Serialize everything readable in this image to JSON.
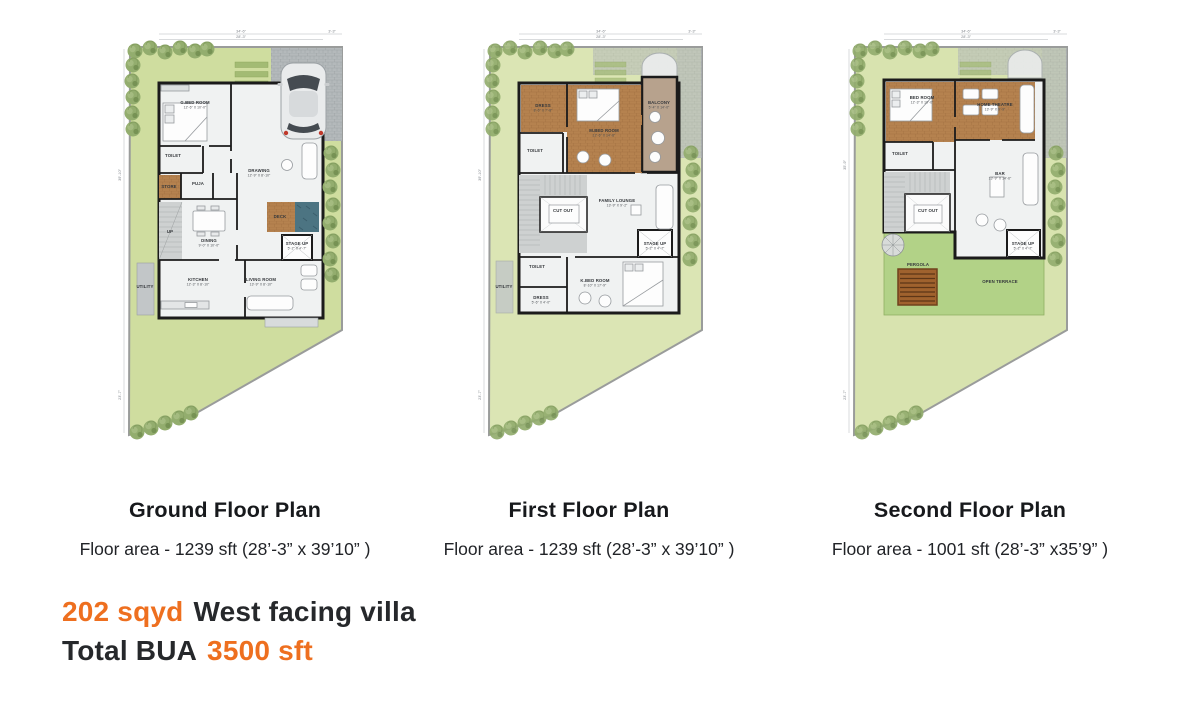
{
  "colors": {
    "accent_orange": "#ee6f1f",
    "heading_text": "#17191c",
    "body_text": "#26282b",
    "lawn_green": "#cfdd9f",
    "terrace_green": "#b2d287",
    "wood_brown": "#b5824f",
    "wall_black": "#1b1b1b",
    "water_blue": "#4c7482",
    "paver_gray": "#b4b9bb",
    "stair_gray": "#ced1d1",
    "balcony_tan": "#b7a28d",
    "pergola_brown": "#a0622e",
    "tree_green": "#93ad6e"
  },
  "plans": [
    {
      "title": "Ground Floor Plan",
      "area_line": "Floor area - 1239 sft (28’-3” x 39’10” )",
      "dims": [
        {
          "text": "34’-6”",
          "x": 136,
          "y": 27.5
        },
        {
          "text": "28’-3”",
          "x": 136,
          "y": 33.2
        },
        {
          "text": "3’-3”",
          "x": 227,
          "y": 27.5
        },
        {
          "text": "39’-10”",
          "x": 16,
          "y": 170,
          "rotate": true
        },
        {
          "text": "23’-7”",
          "x": 16,
          "y": 390,
          "rotate": true
        }
      ],
      "rooms": [
        {
          "label": "G.BED ROOM",
          "dim": "12’-6” X 10’-0”",
          "x": 90,
          "y": 99
        },
        {
          "label": "TOILET",
          "x": 68,
          "y": 152
        },
        {
          "label": "STORE",
          "x": 64,
          "y": 183
        },
        {
          "label": "PUJA",
          "x": 93,
          "y": 180
        },
        {
          "label": "DRAWING",
          "dim": "12’-9” X 8’-10”",
          "x": 154,
          "y": 167
        },
        {
          "label": "DECK",
          "x": 175,
          "y": 213
        },
        {
          "label": "DINING",
          "dim": "9’-0” X 10’-0”",
          "x": 104,
          "y": 237
        },
        {
          "label": "KITCHEN",
          "dim": "12’-3” X 8’-10”",
          "x": 93,
          "y": 276
        },
        {
          "label": "LIVING ROOM",
          "dim": "13’-9” X 8’-10”",
          "x": 156,
          "y": 276
        },
        {
          "label": "STAGE UP",
          "dim": "5’-2” X 4’-7”",
          "x": 192,
          "y": 240
        },
        {
          "label": "UTILITY",
          "x": 40,
          "y": 283
        },
        {
          "label": "UP",
          "x": 65,
          "y": 228
        }
      ]
    },
    {
      "title": "First Floor Plan",
      "area_line": "Floor area - 1239 sft (28’-3” x 39’10” )",
      "dims": [
        {
          "text": "34’-6”",
          "x": 136,
          "y": 27.5
        },
        {
          "text": "28’-3”",
          "x": 136,
          "y": 33.2
        },
        {
          "text": "3’-3”",
          "x": 227,
          "y": 27.5
        },
        {
          "text": "39’-10”",
          "x": 16,
          "y": 170,
          "rotate": true
        },
        {
          "text": "23’-7”",
          "x": 16,
          "y": 390,
          "rotate": true
        }
      ],
      "rooms": [
        {
          "label": "DRESS",
          "dim": "8’-6” X 7’-8”",
          "x": 78,
          "y": 102
        },
        {
          "label": "TOILET",
          "x": 70,
          "y": 147
        },
        {
          "label": "M.BED ROOM",
          "dim": "12’-6” X 14’-6”",
          "x": 139,
          "y": 127
        },
        {
          "label": "BALCONY",
          "dim": "5’-4” X 14’-0”",
          "x": 194,
          "y": 99
        },
        {
          "label": "FAMILY LOUNGE",
          "dim": "13’-9” X 9’-2”",
          "x": 152,
          "y": 197
        },
        {
          "label": "CUT OUT",
          "x": 98,
          "y": 207
        },
        {
          "label": "STAGE UP",
          "dim": "5’-2” X 4’-7”",
          "x": 190,
          "y": 240
        },
        {
          "label": "K.BED ROOM",
          "dim": "8’-10” X 17’-9”",
          "x": 130,
          "y": 277
        },
        {
          "label": "TOILET",
          "x": 72,
          "y": 263
        },
        {
          "label": "DRESS",
          "dim": "5’-6” X 4’-0”",
          "x": 76,
          "y": 294
        },
        {
          "label": "UTILITY",
          "x": 39,
          "y": 283
        }
      ]
    },
    {
      "title": "Second Floor Plan",
      "area_line": "Floor area - 1001 sft (28’-3” x35’9” )",
      "dims": [
        {
          "text": "34’-6”",
          "x": 136,
          "y": 27.5
        },
        {
          "text": "28’-3”",
          "x": 136,
          "y": 33.2
        },
        {
          "text": "3’-3”",
          "x": 227,
          "y": 27.5
        },
        {
          "text": "35’-9”",
          "x": 16,
          "y": 160,
          "rotate": true
        },
        {
          "text": "23’-7”",
          "x": 16,
          "y": 390,
          "rotate": true
        }
      ],
      "rooms": [
        {
          "label": "BED ROOM",
          "dim": "12’-3” X 10’-0”",
          "x": 92,
          "y": 94
        },
        {
          "label": "HOME THEATRE",
          "dim": "13’-9” X 9’-9”",
          "x": 165,
          "y": 101
        },
        {
          "label": "TOILET",
          "x": 70,
          "y": 150
        },
        {
          "label": "BAR",
          "dim": "13’-9” X 14’-6”",
          "x": 170,
          "y": 170
        },
        {
          "label": "CUT OUT",
          "x": 98,
          "y": 207
        },
        {
          "label": "STAGE UP",
          "dim": "5’-2” X 4’-7”",
          "x": 193,
          "y": 240
        },
        {
          "label": "PERGOLA",
          "x": 88,
          "y": 261
        },
        {
          "label": "OPEN TERRACE",
          "x": 170,
          "y": 278
        }
      ]
    }
  ],
  "summary": {
    "lines": [
      [
        {
          "text": "202 sqyd",
          "accent": true
        },
        {
          "text": "West facing villa",
          "accent": false
        }
      ],
      [
        {
          "text": "Total BUA",
          "accent": false
        },
        {
          "text": "3500 sft",
          "accent": true
        }
      ]
    ]
  }
}
